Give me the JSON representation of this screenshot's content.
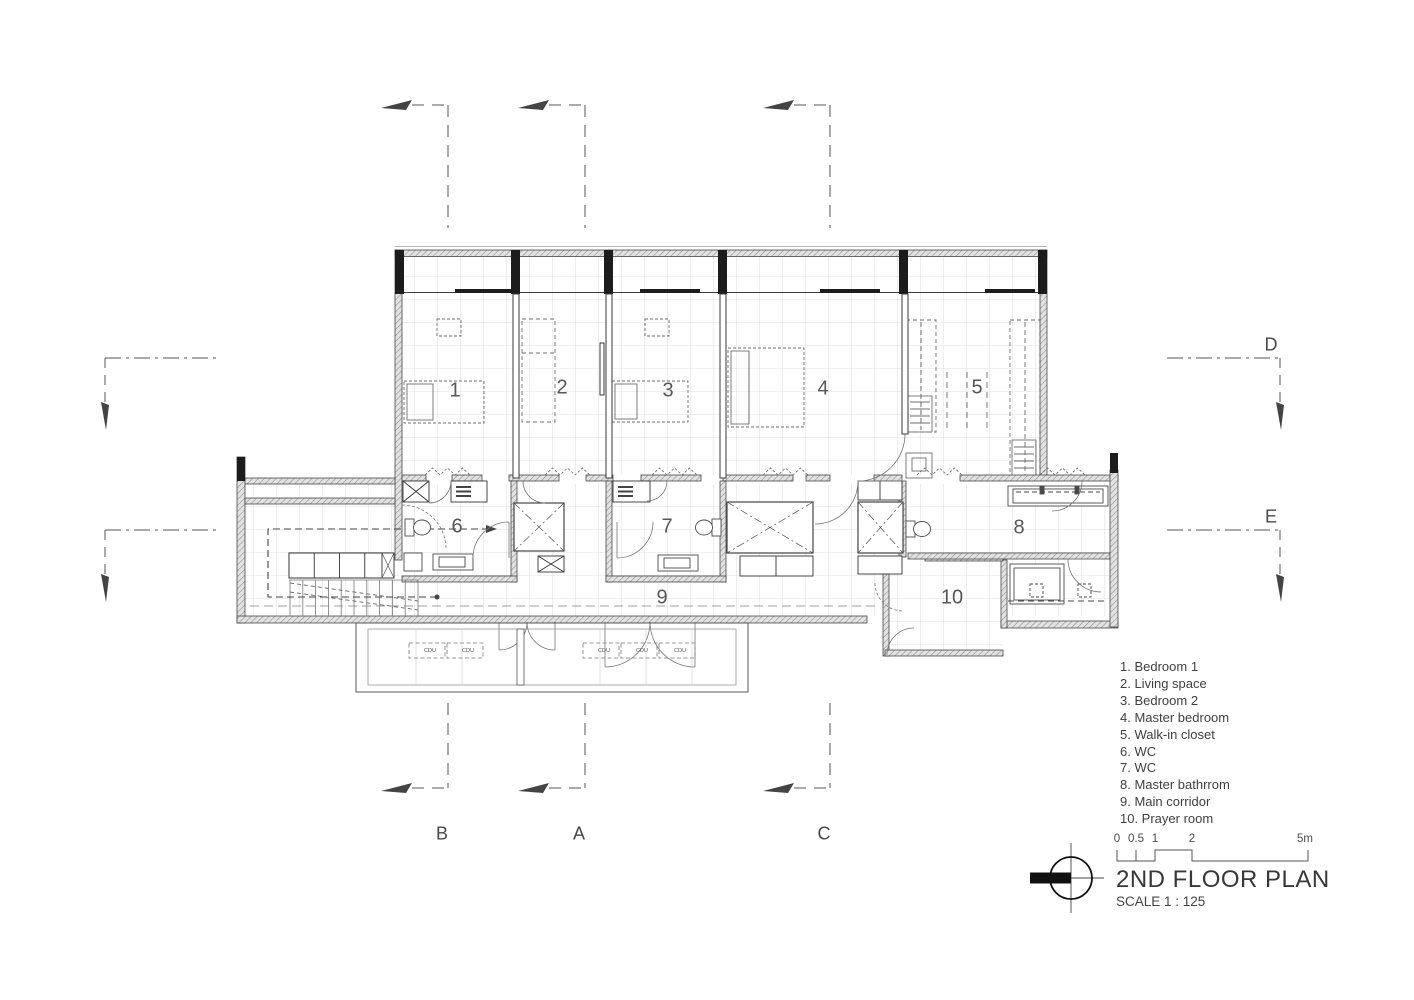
{
  "plan": {
    "rooms": [
      "1",
      "2",
      "3",
      "4",
      "5",
      "6",
      "7",
      "8",
      "9",
      "10"
    ],
    "cdu": "CDU"
  },
  "grid_markers": {
    "bottom": [
      "B",
      "A",
      "C"
    ],
    "right": [
      "D",
      "E"
    ]
  },
  "legend": {
    "items": [
      "1. Bedroom 1",
      "2. Living space",
      "3. Bedroom 2",
      "4. Master bedroom",
      "5. Walk-in closet",
      "6. WC",
      "7. WC",
      "8. Master bathrrom",
      "9. Main corridor",
      "10. Prayer room"
    ]
  },
  "title_block": {
    "title": "2ND FLOOR PLAN",
    "scale": "SCALE 1 : 125",
    "scale_bar_labels": [
      "0",
      "0.5",
      "1",
      "2",
      "5m"
    ]
  },
  "colors": {
    "background": "#ffffff",
    "line": "#3a3a3a",
    "grid": "#c6c6c6",
    "text": "#4a4a4a"
  }
}
